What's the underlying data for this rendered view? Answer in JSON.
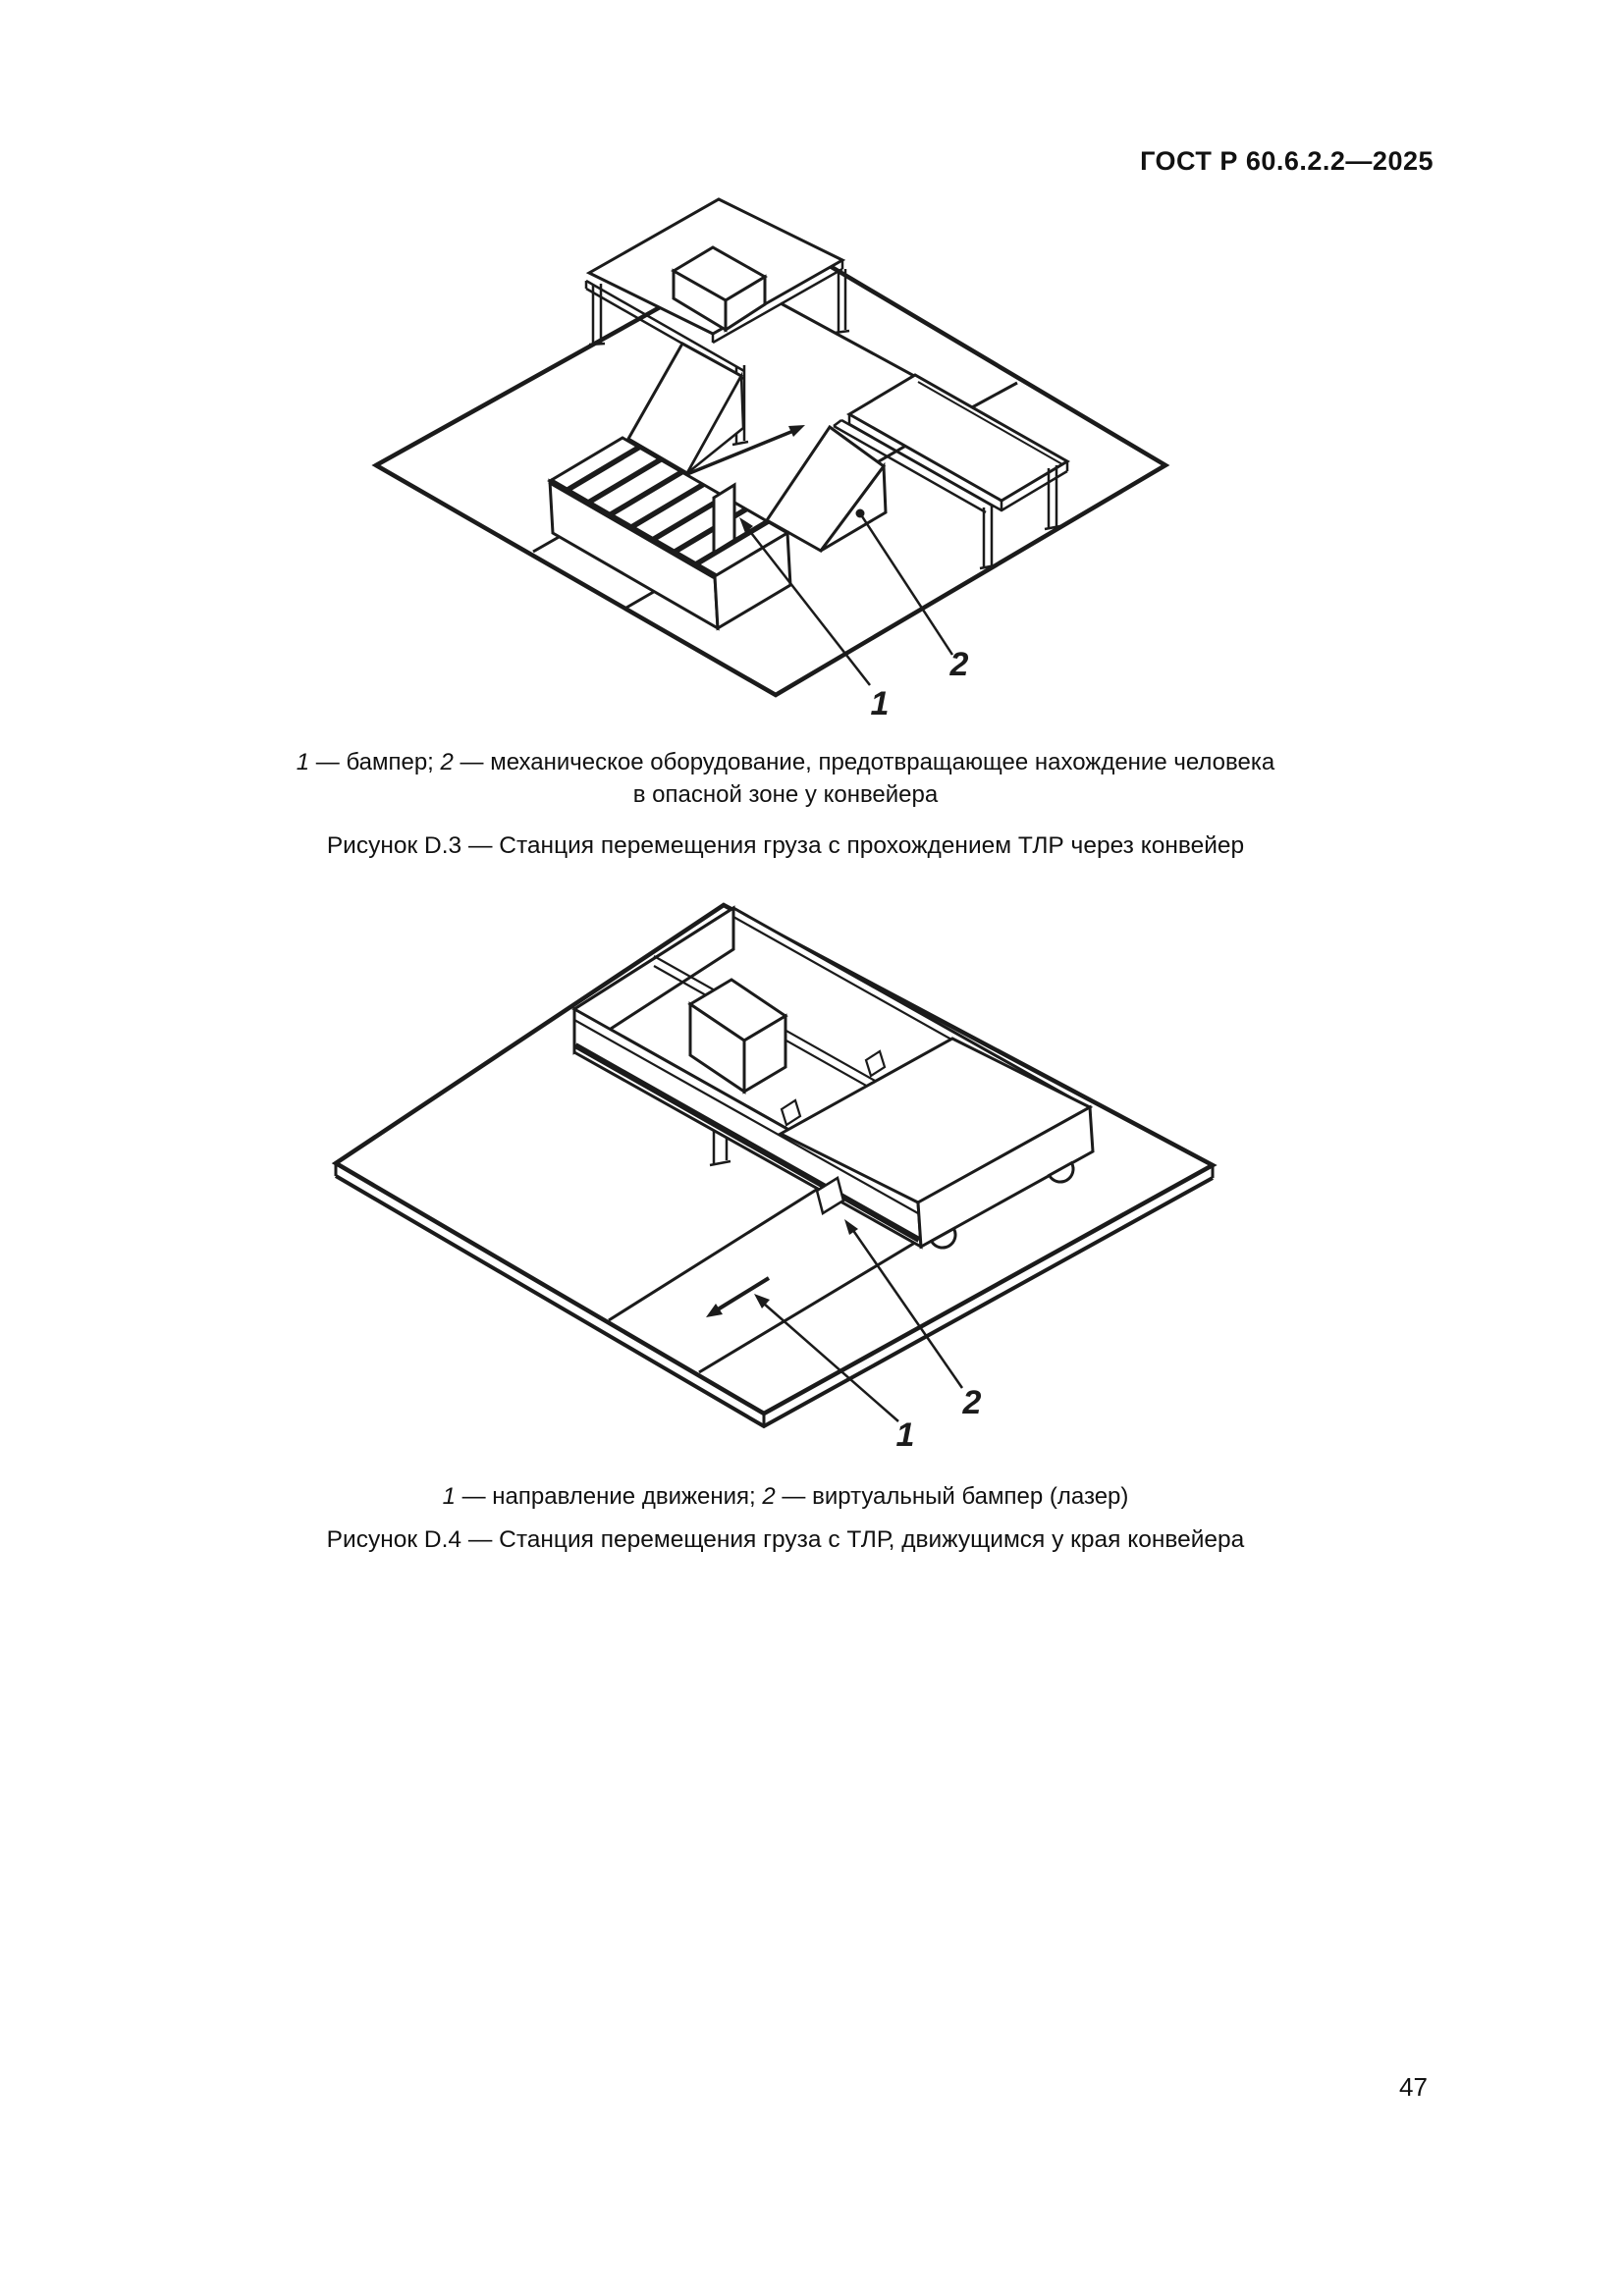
{
  "header": {
    "title": "ГОСТ Р 60.6.2.2—2025"
  },
  "figure_d3": {
    "legend_segments": [
      {
        "text": "1",
        "italic": true
      },
      {
        "text": " — бампер; ",
        "italic": false
      },
      {
        "text": "2",
        "italic": true
      },
      {
        "text": " — механическое оборудование, предотвращающее нахождение человека",
        "italic": false
      }
    ],
    "legend_line2": "в опасной зоне у конвейера",
    "caption": "Рисунок D.3 — Станция перемещения груза с прохождением ТЛР через конвейер",
    "callout_1": "1",
    "callout_2": "2"
  },
  "figure_d4": {
    "legend_segments": [
      {
        "text": "1",
        "italic": true
      },
      {
        "text": " — направление движения; ",
        "italic": false
      },
      {
        "text": "2",
        "italic": true
      },
      {
        "text": " — виртуальный бампер (лазер)",
        "italic": false
      }
    ],
    "caption": "Рисунок D.4 — Станция перемещения груза с ТЛР, движущимся у края конвейера",
    "callout_1": "1",
    "callout_2": "2"
  },
  "footer": {
    "page_number": "47"
  }
}
